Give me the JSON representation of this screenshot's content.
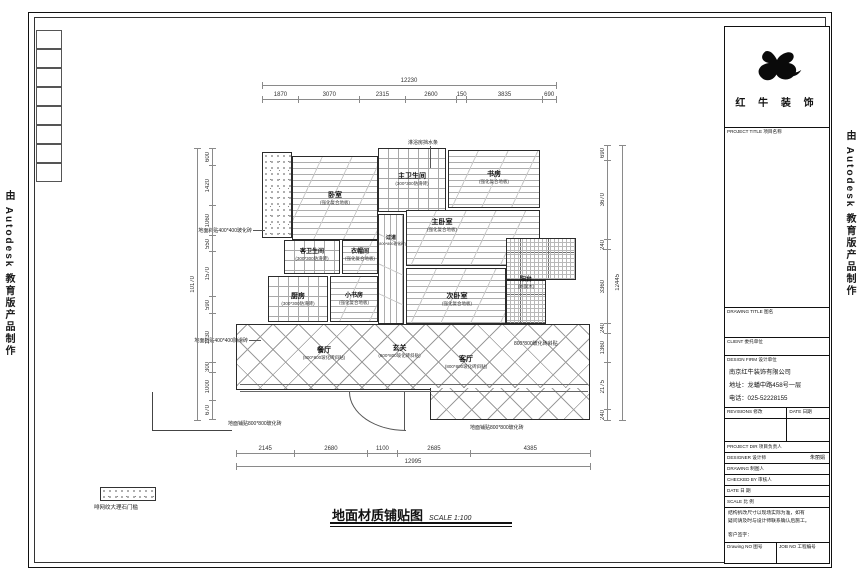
{
  "watermark": {
    "left": "由 Autodesk 教育版产品制作",
    "right": "由 Autodesk 教育版产品制作"
  },
  "sheet": {
    "title": "地面材质铺贴图",
    "scale": "SCALE  1:100"
  },
  "legend": {
    "label": "啡网纹大理石门槛"
  },
  "rooms": {
    "bedroom": {
      "name": "卧室",
      "material": "(强化复合地板)"
    },
    "master_bath": {
      "name": "主卫生间",
      "material": "(300*300防滑砖)"
    },
    "study": {
      "name": "书房",
      "material": "(强化复合地板)"
    },
    "corridor": {
      "name": "过道",
      "material": "(800*800玻化砖)"
    },
    "guest_bath": {
      "name": "客卫生间",
      "material": "(300*300防滑砖)"
    },
    "cloak": {
      "name": "衣帽间",
      "material": "(强化复合地板)"
    },
    "kitchen": {
      "name": "厨房",
      "material": "(300*300防滑砖)"
    },
    "small_study": {
      "name": "小书房",
      "material": "(强化复合地板)"
    },
    "master_bed": {
      "name": "主卧室",
      "material": "(强化复合地板)"
    },
    "second_bed": {
      "name": "次卧室",
      "material": "(强化复合地板)"
    },
    "balcony": {
      "name": "阳台",
      "material": "(防腐木)"
    },
    "dining": {
      "name": "餐厅",
      "material": "(800*800玻化砖斜贴)"
    },
    "foyer": {
      "name": "玄关",
      "material": "(800*800玻化砖斜贴)"
    },
    "living": {
      "name": "客厅",
      "material": "(800*800玻化砖斜贴)"
    }
  },
  "annotations": {
    "shower_bar": "淋浴房挡水条",
    "left_a": "地面斜贴400*400玻化砖",
    "left_b": "地面斜贴400*400防滑砖",
    "bottom_a": "地面铺贴800*800玻化砖",
    "bottom_b": "地面铺贴800*800玻化砖",
    "right_a": "800*800玻化砖斜贴"
  },
  "dims": {
    "top": {
      "total": "12230",
      "segments": [
        "1870",
        "3070",
        "2315",
        "2600",
        "150",
        "3835",
        "690"
      ]
    },
    "bottom": {
      "total": "12995",
      "segments": [
        "2145",
        "2680",
        "1100",
        "2685",
        "4385"
      ]
    },
    "left": {
      "total": "10170",
      "segments": [
        "600",
        "1420",
        "1060",
        "550",
        "1570",
        "590",
        "1730",
        "300",
        "1000",
        "670"
      ]
    },
    "right": {
      "total": "12445",
      "segments": [
        "690",
        "3670",
        "240",
        "3360",
        "240",
        "1360",
        "2175",
        "240"
      ]
    }
  },
  "title_block": {
    "brand": "红 牛 装 饰",
    "project_title": "PROJECT TITLE  项目名称",
    "drawing_title": "DRAWING TITLE  图名",
    "client": "CLIENT  委托单位",
    "design_firm": "DESIGN FIRM  设计单位",
    "company": "南京红牛装饰有限公司",
    "address": "地址：龙蟠中路458号一层",
    "phone": "电话：025-52228155",
    "revisions": "REVISIONS  修改",
    "date_col": "DATE  日期",
    "rows": [
      {
        "label": "PROJECT DIR  项目负责人",
        "value": ""
      },
      {
        "label": "DESIGNER  设计师",
        "value": "朱丽娟"
      },
      {
        "label": "DRAWING  制图人",
        "value": ""
      },
      {
        "label": "CHECKED BY  审核人",
        "value": ""
      },
      {
        "label": "DATE  日 期",
        "value": ""
      },
      {
        "label": "SCALE  比 例",
        "value": ""
      }
    ],
    "note_line1": "结构拆改尺寸以现场实际为准，如有",
    "note_line2": "疑问请及时与设计师联系确认后施工。",
    "note_sign": "客户签字：",
    "drawing_no": "Drawing NO  图号",
    "job_no": "JOB NO  工程编号"
  }
}
